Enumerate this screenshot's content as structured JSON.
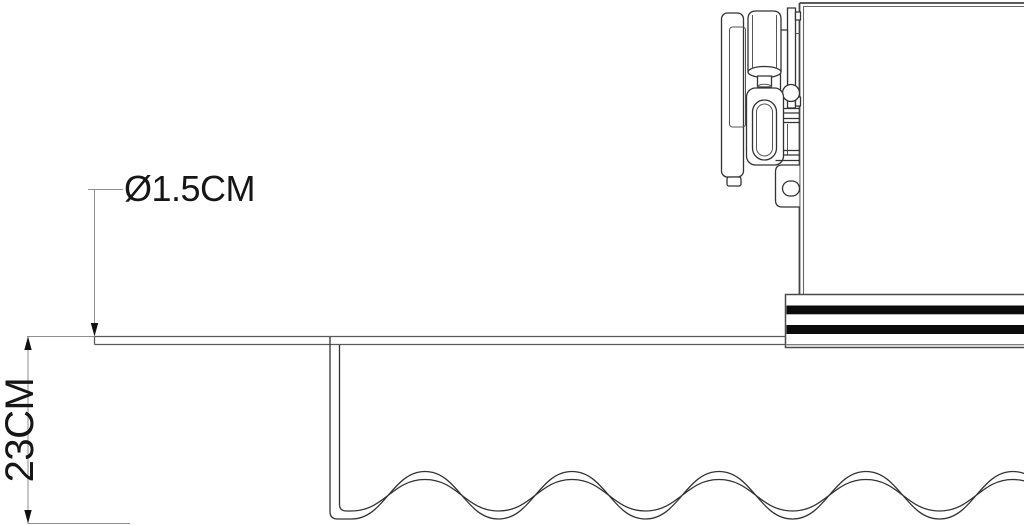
{
  "dimensions": {
    "diameter_label": "Ø1.5CM",
    "height_label": "23CM"
  },
  "colors": {
    "background": "#ffffff",
    "outline": "#333333",
    "box_edge": "#444444",
    "dimension_line": "#8f8f8f",
    "stripe_black": "#0b0b0b",
    "label_text": "#161616"
  }
}
